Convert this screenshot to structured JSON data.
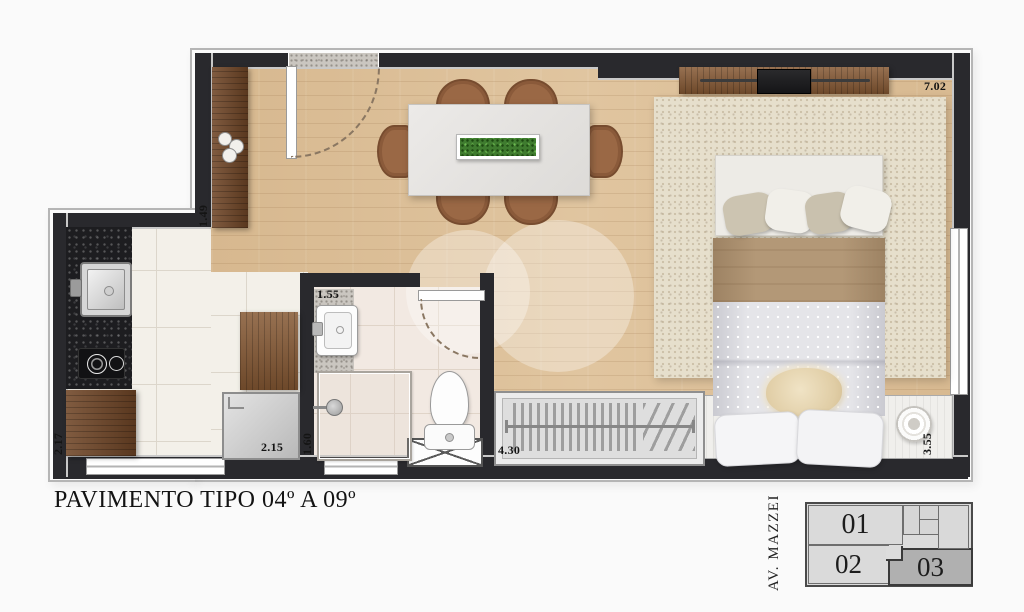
{
  "title": "PAVIMENTO TIPO 04º A 09º",
  "dimensions": {
    "living_width": "7.02",
    "entry_cabinet": "1.49",
    "bathroom_width": "1.55",
    "shower_depth": "1.60",
    "kitchen_depth": "2.17",
    "kitchen_width": "2.15",
    "service_window": "4.30",
    "bedroom_width": "3.55"
  },
  "key_plan": {
    "street_label": "AV. MAZZEI",
    "units": [
      {
        "label": "01",
        "highlighted": false
      },
      {
        "label": "02",
        "highlighted": false
      },
      {
        "label": "03",
        "highlighted": true
      }
    ]
  },
  "colors": {
    "wall": "#29292d",
    "wood_floor": "#dcc09a",
    "kitchen_tile": "#f3f0e9",
    "bathroom_tile": "#f2e9e2",
    "rug": "#e6dfcc",
    "cabinet_wood": "#855833",
    "counter_granite": "#1d1d20",
    "highlighted_unit": "#b0b0b0"
  }
}
